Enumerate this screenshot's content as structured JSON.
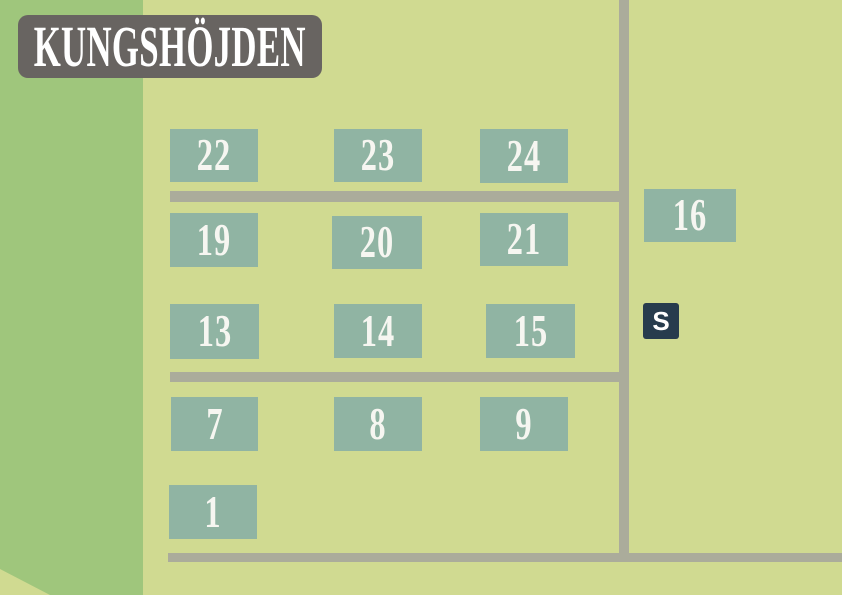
{
  "title": "KUNGSHÖJDEN",
  "colors": {
    "background": "#d0da91",
    "forest_band": "#9fc67c",
    "road": "#abac9b",
    "plot_box": "#90b4a3",
    "plot_text": "#f6f6f1",
    "title_bg": "#686461",
    "title_text": "#ffffff",
    "marker_bg": "#273c4d",
    "marker_text": "#ffffff"
  },
  "marker": {
    "label": "S",
    "x": 643,
    "y": 303,
    "size": 36
  },
  "plots": [
    {
      "label": "22",
      "x": 170,
      "y": 129,
      "w": 88,
      "h": 53
    },
    {
      "label": "23",
      "x": 334,
      "y": 129,
      "w": 88,
      "h": 53
    },
    {
      "label": "24",
      "x": 480,
      "y": 129,
      "w": 88,
      "h": 54
    },
    {
      "label": "19",
      "x": 170,
      "y": 213,
      "w": 88,
      "h": 54
    },
    {
      "label": "20",
      "x": 332,
      "y": 216,
      "w": 90,
      "h": 53
    },
    {
      "label": "21",
      "x": 480,
      "y": 213,
      "w": 88,
      "h": 53
    },
    {
      "label": "13",
      "x": 170,
      "y": 304,
      "w": 89,
      "h": 55
    },
    {
      "label": "14",
      "x": 334,
      "y": 304,
      "w": 88,
      "h": 54
    },
    {
      "label": "15",
      "x": 486,
      "y": 304,
      "w": 89,
      "h": 54
    },
    {
      "label": "7",
      "x": 171,
      "y": 397,
      "w": 87,
      "h": 54
    },
    {
      "label": "8",
      "x": 334,
      "y": 397,
      "w": 88,
      "h": 54
    },
    {
      "label": "9",
      "x": 480,
      "y": 397,
      "w": 88,
      "h": 54
    },
    {
      "label": "1",
      "x": 169,
      "y": 485,
      "w": 88,
      "h": 54
    },
    {
      "label": "16",
      "x": 644,
      "y": 189,
      "w": 92,
      "h": 53
    }
  ],
  "roads": [
    {
      "name": "road-vertical",
      "x": 619,
      "y": 0,
      "w": 10,
      "h": 562
    },
    {
      "name": "road-horizontal-upper",
      "x": 170,
      "y": 191,
      "w": 459,
      "h": 11
    },
    {
      "name": "road-horizontal-middle",
      "x": 170,
      "y": 372,
      "w": 459,
      "h": 10
    },
    {
      "name": "road-horizontal-bottom",
      "x": 168,
      "y": 553,
      "w": 674,
      "h": 9
    }
  ]
}
